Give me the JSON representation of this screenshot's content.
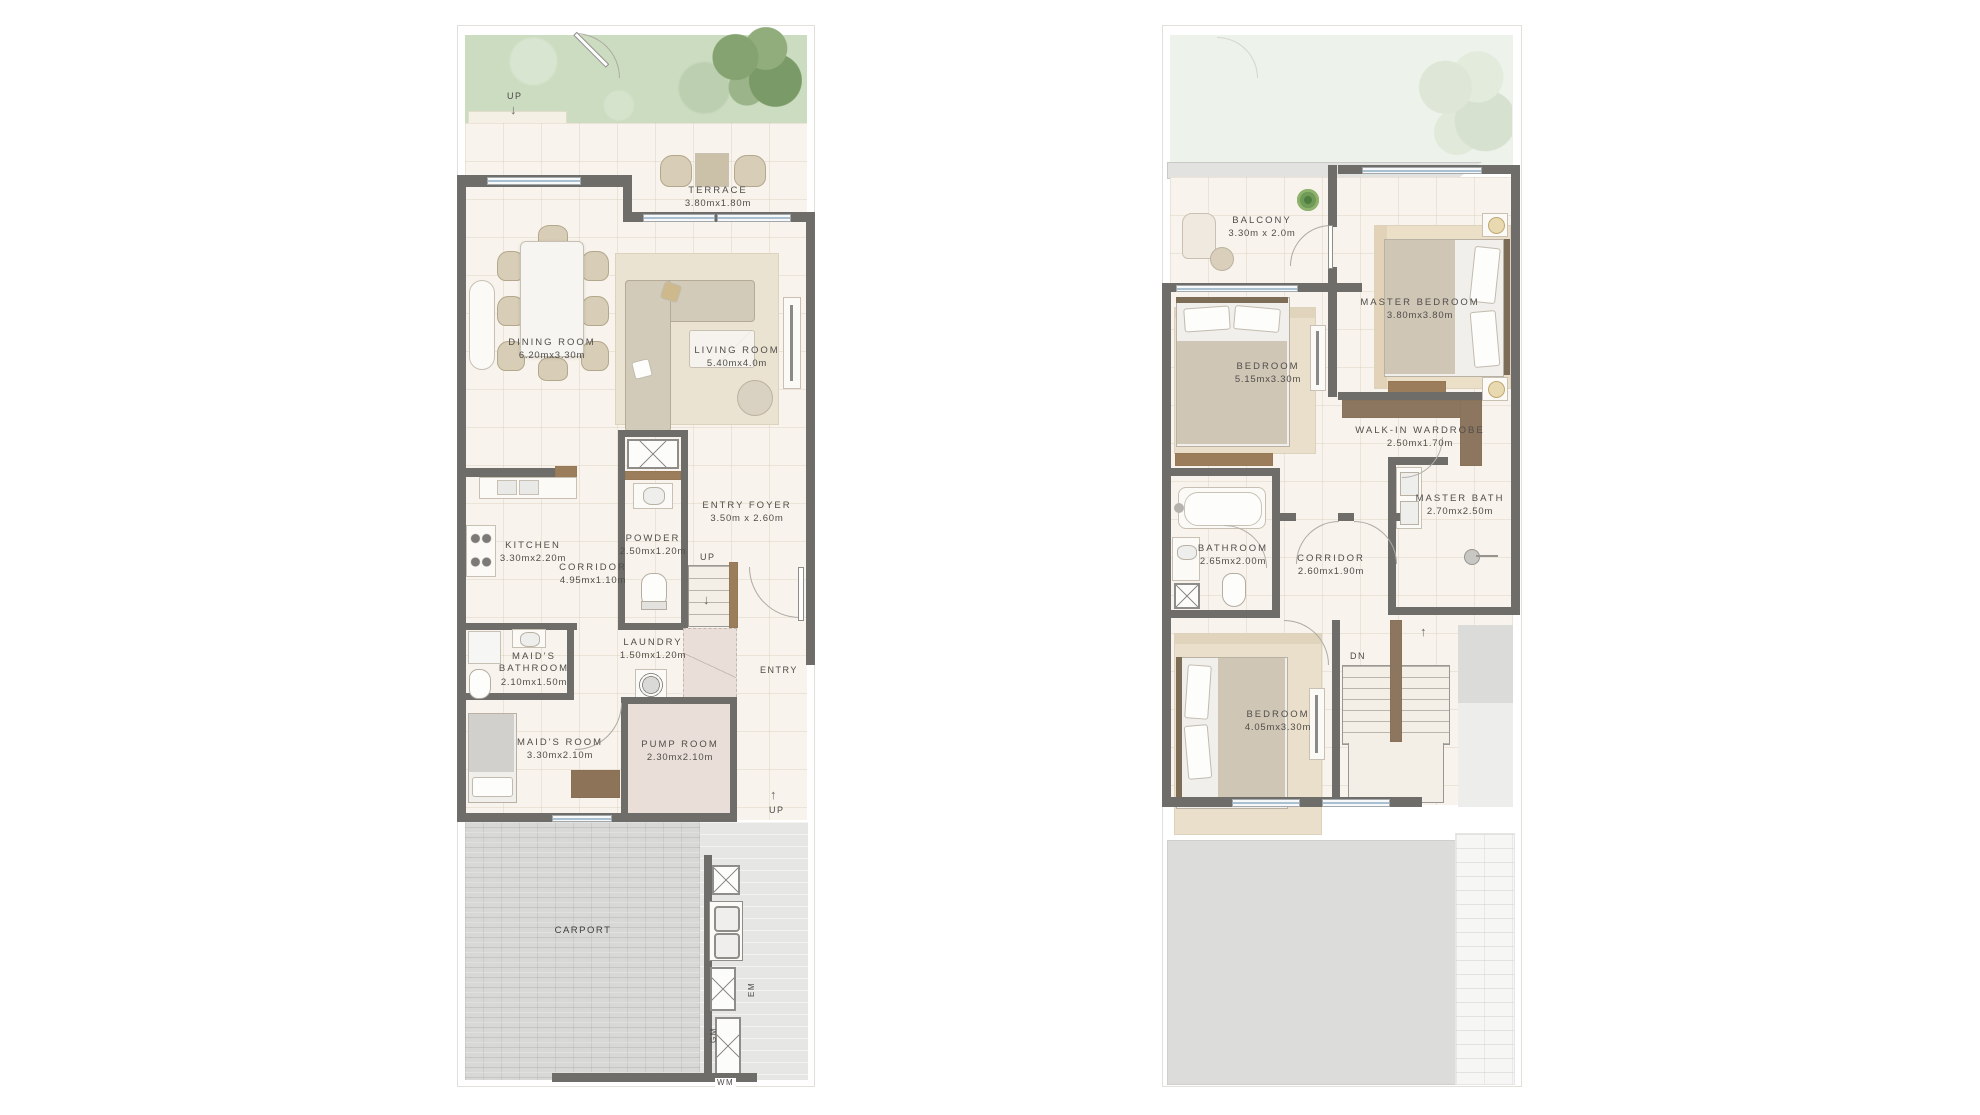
{
  "ground_floor": {
    "garden": {
      "up": "UP"
    },
    "rooms": {
      "terrace": {
        "name": "TERRACE",
        "dims": "3.80mx1.80m"
      },
      "dining_room": {
        "name": "DINING ROOM",
        "dims": "6.20mx3.30m"
      },
      "living_room": {
        "name": "LIVING ROOM",
        "dims": "5.40mx4.0m"
      },
      "kitchen": {
        "name": "KITCHEN",
        "dims": "3.30mx2.20m"
      },
      "corridor": {
        "name": "CORRIDOR",
        "dims": "4.95mx1.10m"
      },
      "powder": {
        "name": "POWDER",
        "dims": "2.50mx1.20m"
      },
      "entry_foyer": {
        "name": "ENTRY FOYER",
        "dims": "3.50m x 2.60m"
      },
      "maids_bathroom": {
        "name": "MAID'S BATHROOM",
        "dims": "2.10mx1.50m"
      },
      "laundry": {
        "name": "LAUNDRY",
        "dims": "1.50mx1.20m"
      },
      "maids_room": {
        "name": "MAID'S ROOM",
        "dims": "3.30mx2.10m"
      },
      "pump_room": {
        "name": "PUMP ROOM",
        "dims": "2.30mx2.10m"
      },
      "carport": {
        "name": "CARPORT"
      }
    },
    "labels": {
      "stairs_up": "UP",
      "entry": "ENTRY",
      "carport_up": "UP",
      "em": "EM",
      "gm": "GM",
      "wm": "WM"
    }
  },
  "first_floor": {
    "rooms": {
      "balcony": {
        "name": "BALCONY",
        "dims": "3.30m x 2.0m"
      },
      "master_bedroom": {
        "name": "MASTER BEDROOM",
        "dims": "3.80mx3.80m"
      },
      "bedroom_front": {
        "name": "BEDROOM",
        "dims": "5.15mx3.30m"
      },
      "walk_in_wardrobe": {
        "name": "WALK-IN WARDROBE",
        "dims": "2.50mx1.70m"
      },
      "master_bath": {
        "name": "MASTER BATH",
        "dims": "2.70mx2.50m"
      },
      "bathroom": {
        "name": "BATHROOM",
        "dims": "2.65mx2.00m"
      },
      "corridor": {
        "name": "CORRIDOR",
        "dims": "2.60mx1.90m"
      },
      "bedroom_back": {
        "name": "BEDROOM",
        "dims": "4.05mx3.30m"
      }
    },
    "labels": {
      "stairs_dn": "DN"
    }
  },
  "colors": {
    "wall": "#6F6D6A",
    "floor": "#F8F3EC",
    "garden": "#CBDCC0",
    "garden_faded": "#EDF2EA",
    "carport": "#D8D8D6",
    "wood": "#9B7D5C",
    "glass": "#A9C0D0",
    "service_floor": "#E9DFD8"
  }
}
